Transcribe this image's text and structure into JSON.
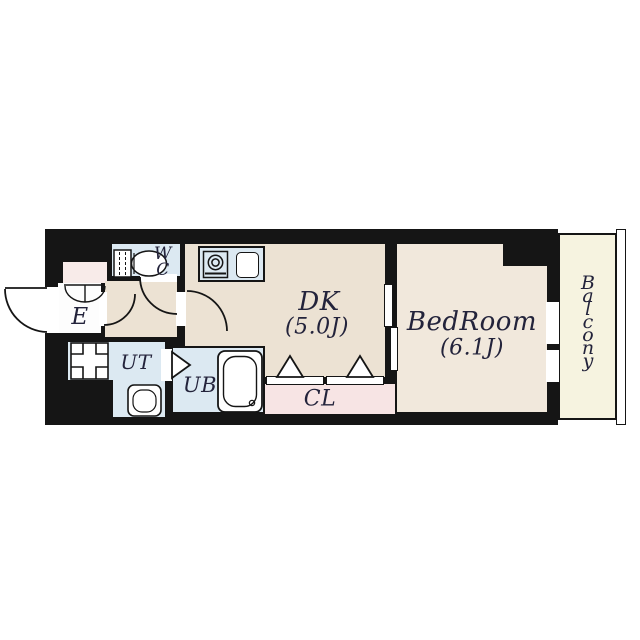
{
  "rooms": {
    "wc": {
      "lines": [
        "W",
        "C"
      ]
    },
    "entrance": {
      "label": "E"
    },
    "utility": {
      "label": "UT"
    },
    "unit_bath": {
      "label": "UB"
    },
    "dk": {
      "label": "DK",
      "size": "(5.0J)"
    },
    "closet": {
      "label": "CL"
    },
    "bedroom": {
      "label": "BedRoom",
      "size": "(6.1J)"
    },
    "balcony": {
      "label": "Balcony",
      "letters": [
        "B",
        "a",
        "l",
        "c",
        "o",
        "n",
        "y"
      ]
    }
  },
  "colors": {
    "wall": "#151515",
    "wet_area_blue": "#dce9f2",
    "dk_beige": "#ece2d3",
    "bedroom_beige": "#f1e8dc",
    "closet_pink": "#f7e4e4",
    "entry_pink": "#f8ebe9",
    "balcony_cream": "#f6f3e0",
    "text": "#23233b"
  },
  "icons": [
    "toilet-icon",
    "stove-icon",
    "sink-icon",
    "bathtub-icon",
    "washbasin-icon",
    "washer-pan-icon",
    "shoe-cabinet-icon",
    "entrance-door-arc-icon",
    "wc-door-arc-icon",
    "hall-door-arc-icon",
    "dk-door-arc-icon",
    "folding-door-icon",
    "closet-folding-door-icon",
    "sliding-door-icon",
    "window-icon",
    "balcony-railing-icon"
  ]
}
